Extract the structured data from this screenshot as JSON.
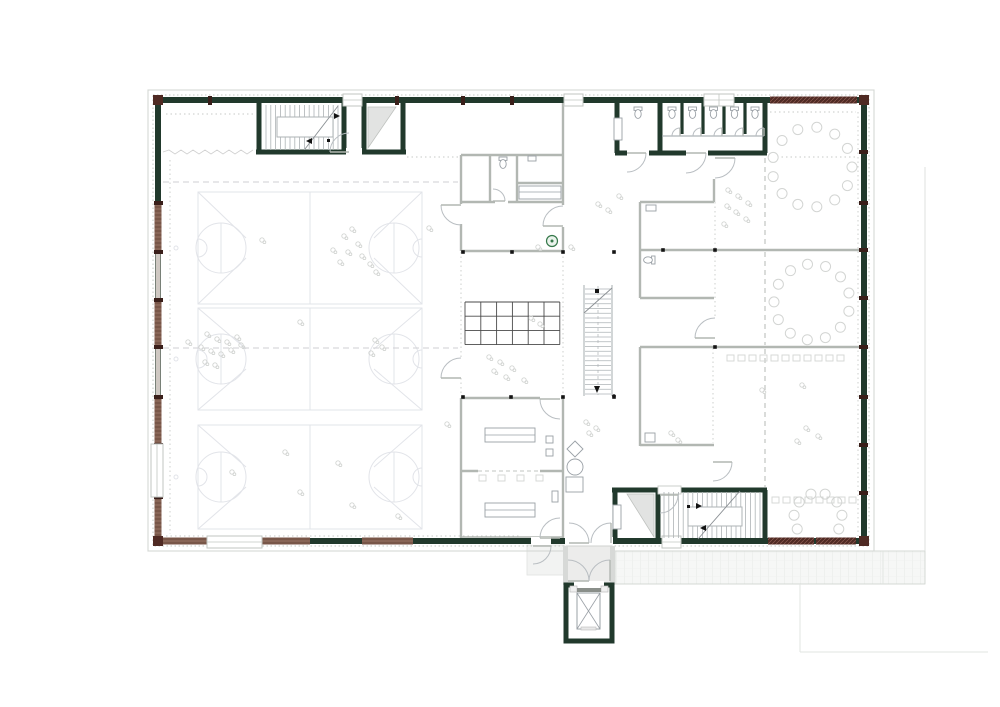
{
  "colors": {
    "wall_green": "#21392c",
    "wall_gray": "#b2b7b2",
    "band": "#ccd1cc",
    "wood": "#7d5a4c",
    "wood_line": "#9b7a6a",
    "pale_wood": "#cfc8c2",
    "maroon": "#4f2a23",
    "dark_tick": "#3a1f1a",
    "line_light": "#b9bec2",
    "dotted": "#c7cac7",
    "dashed": "#c2c5c2",
    "curtain": "#cfcfd3",
    "court": "#e2e4e9",
    "figure": "#d3d5d3",
    "stair": "#aeb3b6",
    "stair_edge": "#8a8f93",
    "furniture": "#9aa0a6",
    "grid_dark": "#4a4a4a",
    "green_accent": "#35784a",
    "paving_fill": "#f6f7f6",
    "paving_line": "#e7e9e7",
    "vestibule_fill": "#ececeb",
    "triangle_fill": "#e2e3e2",
    "black": "#141414",
    "white": "#ffffff"
  },
  "plan": {
    "canvas": {
      "w": 1000,
      "h": 707
    },
    "building": {
      "x": 158,
      "y": 100,
      "w": 706,
      "h": 441
    },
    "courts": {
      "x1": 198,
      "x2": 422,
      "cx": 310,
      "circle_r": 25,
      "circle_cx": [
        221,
        394
      ],
      "rows": [
        {
          "cy": 248,
          "hh": 56
        },
        {
          "cy": 359,
          "hh": 51
        },
        {
          "cy": 477,
          "hh": 52
        }
      ]
    },
    "curtains_y": [
      182,
      348
    ],
    "wood_left": [
      [
        203,
        252
      ],
      [
        300,
        347
      ],
      [
        397,
        445
      ],
      [
        497,
        538
      ]
    ],
    "pale_left": [
      [
        252,
        300
      ],
      [
        347,
        397
      ]
    ],
    "wood_bottom": [
      [
        160,
        207
      ],
      [
        262,
        310
      ],
      [
        362,
        413
      ]
    ],
    "hatch_bottom": [
      [
        768,
        814
      ],
      [
        816,
        856
      ]
    ],
    "hatch_top": [
      [
        770,
        857
      ]
    ],
    "ticks_left": [
      203,
      252,
      300,
      347,
      397,
      445,
      497
    ],
    "ticks_right": [
      152,
      203,
      250,
      298,
      347,
      397,
      445,
      493
    ],
    "ticks_top": [
      210,
      397,
      463,
      512
    ],
    "corners": [
      [
        158,
        100
      ],
      [
        864,
        100
      ],
      [
        158,
        541
      ],
      [
        864,
        541
      ]
    ],
    "windows_top": [
      [
        343,
        19
      ],
      [
        564,
        19
      ],
      [
        704,
        30
      ]
    ],
    "windows_bottom": [
      [
        207,
        55
      ],
      [
        662,
        19
      ]
    ],
    "windows_left": [
      [
        444,
        53
      ]
    ],
    "grid": {
      "x": 465,
      "y": 302,
      "cols": 6,
      "rows": 3,
      "cw": 15.8,
      "rh": 14.2
    },
    "stalls": {
      "x0": 662,
      "x1": 765,
      "partitions": [
        682,
        703,
        724,
        745
      ],
      "toilet_cx": [
        672,
        692.5,
        713.5,
        734.5,
        755
      ],
      "toilet_cy": 112
    },
    "dots": [
      [
        463,
        252
      ],
      [
        512,
        252
      ],
      [
        563,
        252
      ],
      [
        614,
        252
      ],
      [
        663,
        250
      ],
      [
        463,
        397
      ],
      [
        511,
        397
      ],
      [
        563,
        397
      ],
      [
        614,
        397
      ],
      [
        715,
        250
      ],
      [
        715,
        347
      ]
    ],
    "doors": [
      [
        349,
        152,
        19,
        270,
        180
      ],
      [
        627,
        153,
        19,
        90,
        0
      ],
      [
        686,
        153,
        20,
        90,
        0
      ],
      [
        715,
        158,
        20,
        90,
        0
      ],
      [
        715,
        338,
        20,
        270,
        180
      ],
      [
        713,
        462,
        19,
        90,
        0
      ],
      [
        461,
        205,
        20,
        90,
        180
      ],
      [
        461,
        378,
        20,
        270,
        180
      ],
      [
        563,
        226,
        20,
        270,
        180
      ],
      [
        493,
        201,
        12,
        270,
        0
      ],
      [
        560,
        399,
        20,
        90,
        180
      ],
      [
        560,
        538,
        20,
        270,
        180
      ],
      [
        660,
        495,
        18,
        90,
        0
      ],
      [
        533,
        546,
        18,
        90,
        0
      ],
      [
        680,
        136,
        8,
        180,
        270
      ],
      [
        701,
        136,
        8,
        180,
        270
      ],
      [
        722,
        136,
        8,
        180,
        270
      ],
      [
        743,
        136,
        8,
        180,
        270
      ],
      [
        764,
        136,
        8,
        180,
        270
      ],
      [
        568,
        581,
        21,
        270,
        0
      ],
      [
        610,
        581,
        21,
        180,
        270
      ],
      [
        569,
        543,
        20,
        270,
        0
      ],
      [
        611,
        543,
        20,
        180,
        270
      ]
    ],
    "gaps": [
      [
        346,
        148,
        16,
        8
      ],
      [
        627,
        149,
        22,
        8
      ],
      [
        686,
        149,
        22,
        8
      ],
      [
        458,
        204,
        6,
        20
      ],
      [
        458,
        357,
        6,
        21
      ],
      [
        560,
        205,
        6,
        22
      ],
      [
        540,
        395,
        21,
        6
      ],
      [
        712,
        157,
        6,
        22
      ],
      [
        712,
        317,
        6,
        22
      ],
      [
        495,
        199,
        13,
        6
      ],
      [
        565,
        537,
        48,
        9
      ],
      [
        531,
        537,
        20,
        8
      ]
    ],
    "rings": [
      {
        "cx": 812,
        "cy": 167,
        "r": 40,
        "n": 13,
        "a0": 0,
        "a1": 360
      },
      {
        "cx": 812,
        "cy": 302,
        "r": 38,
        "n": 13,
        "a0": 14,
        "a1": 374
      },
      {
        "cx": 818,
        "cy": 517,
        "r": 24,
        "n": 8,
        "a0": 150,
        "a1": 390
      }
    ],
    "chair_rows": [
      {
        "x": 727,
        "y": 355,
        "n": 11,
        "dx": 11
      },
      {
        "x": 772,
        "y": 497,
        "n": 8,
        "dx": 11
      },
      {
        "x": 479,
        "y": 475,
        "n": 4,
        "dx": 19
      }
    ],
    "scatter": [
      [
        344,
        236
      ],
      [
        352,
        229
      ],
      [
        358,
        244
      ],
      [
        348,
        252
      ],
      [
        362,
        256
      ],
      [
        370,
        264
      ],
      [
        376,
        272
      ],
      [
        340,
        262
      ],
      [
        333,
        250
      ],
      [
        429,
        228
      ],
      [
        207,
        334
      ],
      [
        217,
        339
      ],
      [
        227,
        342
      ],
      [
        237,
        337
      ],
      [
        201,
        347
      ],
      [
        211,
        351
      ],
      [
        221,
        354
      ],
      [
        231,
        350
      ],
      [
        241,
        345
      ],
      [
        205,
        362
      ],
      [
        215,
        365
      ],
      [
        188,
        342
      ],
      [
        300,
        322
      ],
      [
        262,
        240
      ],
      [
        375,
        340
      ],
      [
        382,
        347
      ],
      [
        371,
        353
      ],
      [
        285,
        452
      ],
      [
        338,
        463
      ],
      [
        300,
        492
      ],
      [
        232,
        472
      ],
      [
        352,
        505
      ],
      [
        398,
        516
      ],
      [
        489,
        357
      ],
      [
        500,
        362
      ],
      [
        512,
        368
      ],
      [
        494,
        371
      ],
      [
        506,
        377
      ],
      [
        524,
        380
      ],
      [
        531,
        318
      ],
      [
        540,
        324
      ],
      [
        598,
        204
      ],
      [
        608,
        210
      ],
      [
        619,
        196
      ],
      [
        571,
        247
      ],
      [
        538,
        247
      ],
      [
        728,
        190
      ],
      [
        738,
        196
      ],
      [
        748,
        203
      ],
      [
        727,
        206
      ],
      [
        736,
        212
      ],
      [
        746,
        219
      ],
      [
        724,
        224
      ],
      [
        802,
        385
      ],
      [
        806,
        428
      ],
      [
        818,
        436
      ],
      [
        797,
        441
      ],
      [
        762,
        390
      ],
      [
        586,
        422
      ],
      [
        596,
        428
      ],
      [
        589,
        433
      ],
      [
        447,
        424
      ],
      [
        671,
        433
      ],
      [
        678,
        440
      ]
    ]
  }
}
